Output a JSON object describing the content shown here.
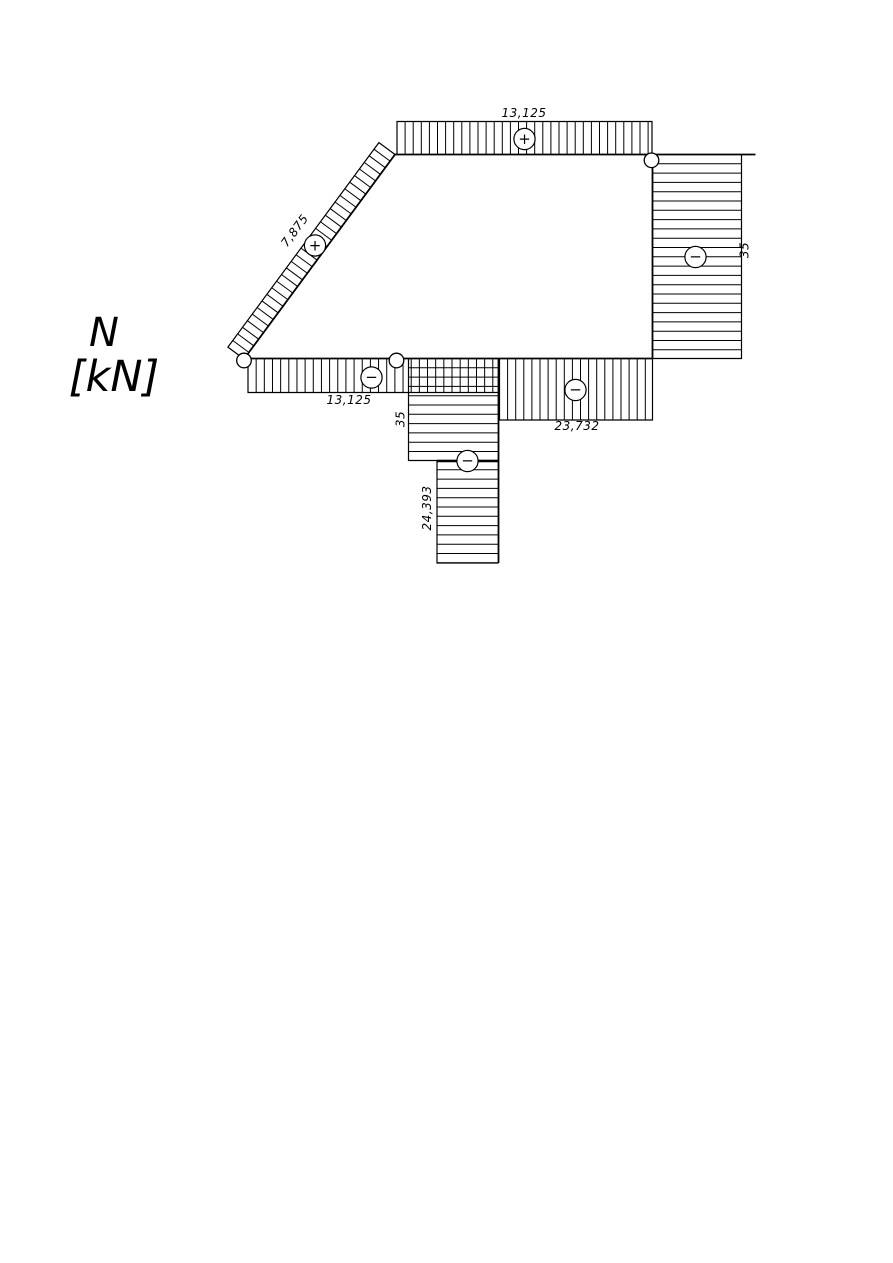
{
  "title": {
    "symbol": "N",
    "unit": "[kN]"
  },
  "diagram": {
    "kind": "axial-force-diagram",
    "unit": "kN",
    "signs": {
      "plus": "+",
      "minus": "−"
    },
    "members": {
      "top_chord": {
        "label": "13,125",
        "value": 13.125,
        "sign": "+"
      },
      "diagonal": {
        "label": "7,875",
        "value": 7.875,
        "sign": "+"
      },
      "right_column": {
        "label": "35",
        "value": -35,
        "sign": "−"
      },
      "bottom_chord_left": {
        "label": "13,125",
        "value": -13.125,
        "sign": "−"
      },
      "bottom_chord_right": {
        "label": "23,732",
        "value": -23.732,
        "sign": "−"
      },
      "lower_column_top": {
        "label": "35",
        "value": -35,
        "sign": "−"
      },
      "lower_column_bottom": {
        "label": "24,393",
        "value": -24.393,
        "sign": "−"
      }
    }
  }
}
